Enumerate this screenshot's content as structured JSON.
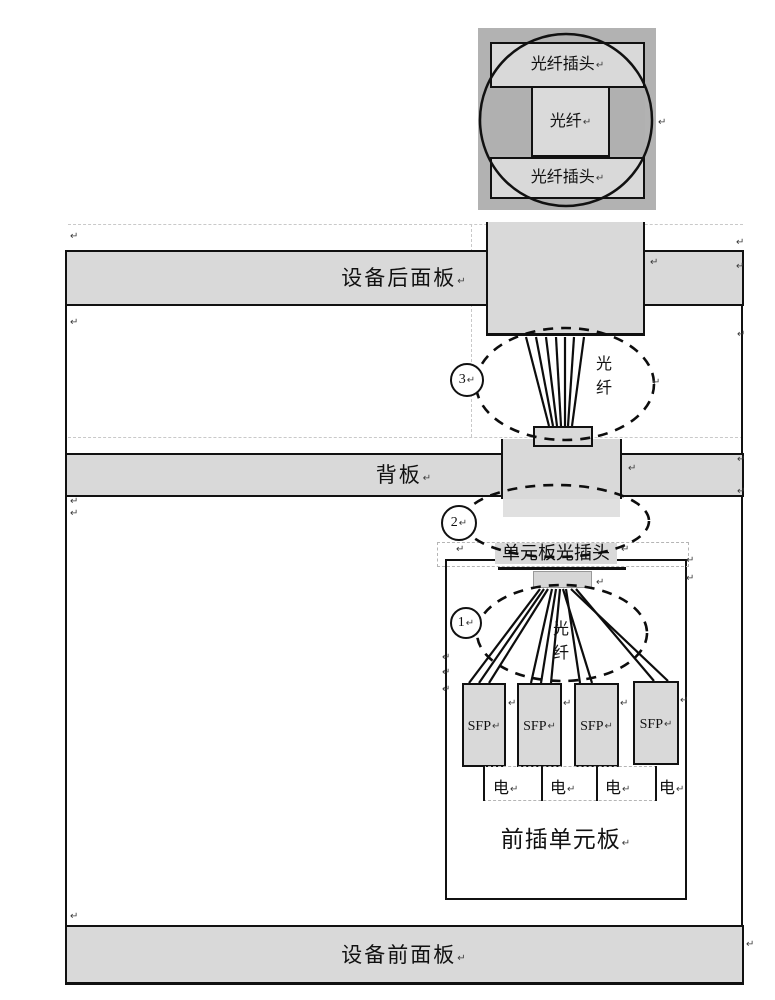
{
  "top_figure": {
    "plug_top": "光纤插头",
    "fiber_core": "光纤",
    "plug_bottom": "光纤插头"
  },
  "panels": {
    "rear_panel": "设备后面板",
    "backplane": "背板",
    "front_panel": "设备前面板"
  },
  "unit_board": {
    "title": "前插单元板",
    "optical_plug_label": "单元板光插头",
    "sfp_modules": [
      "SFP",
      "SFP",
      "SFP",
      "SFP"
    ],
    "electrical_labels": [
      "电",
      "电",
      "电",
      "电"
    ]
  },
  "callouts": {
    "c1": {
      "number": "1",
      "label": "光纤"
    },
    "c2": {
      "number": "2",
      "label": ""
    },
    "c3": {
      "number": "3",
      "label": "光纤"
    }
  },
  "marks": {
    "pilcrow": "↵"
  },
  "colors": {
    "panel_gray": "#d9d9d9",
    "photo_background": "#b2b2b2",
    "line_black": "#111111"
  }
}
